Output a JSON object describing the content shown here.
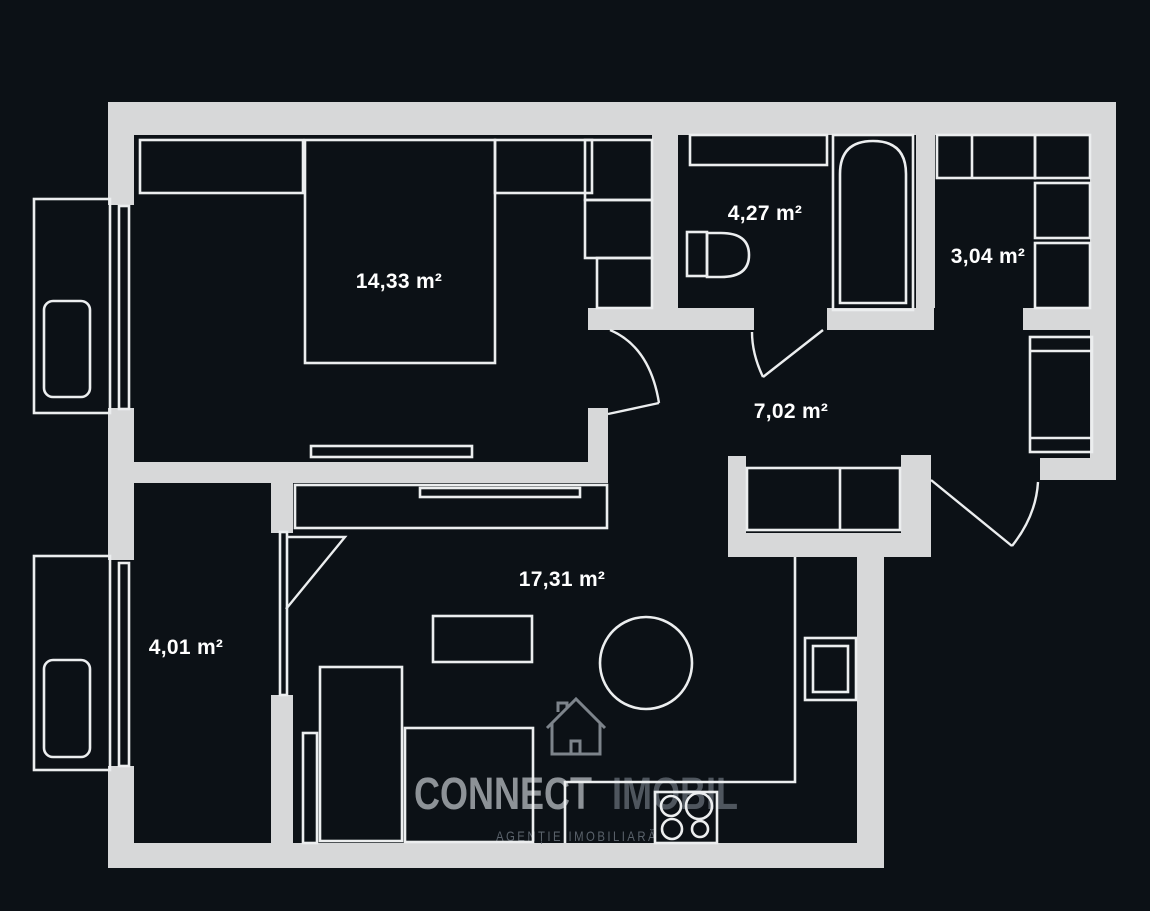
{
  "colors": {
    "background": "#0c1116",
    "wall": "#d7d8d9",
    "furniture_line": "#eceeef",
    "label_text": "#ffffff",
    "logo_primary": "#8d9297",
    "logo_secondary": "#4f565e",
    "tagline": "#5a626b",
    "watermark_icon": "#7d848b"
  },
  "branding": {
    "logo_primary": "CONNECT",
    "logo_secondary": "IMOBIL",
    "tagline": "AGENȚIE IMOBILIARĂ"
  },
  "rooms": [
    {
      "id": "bedroom",
      "area_label": "14,33 m²"
    },
    {
      "id": "bathroom",
      "area_label": "4,27 m²"
    },
    {
      "id": "dressing",
      "area_label": "3,04 m²"
    },
    {
      "id": "hallway",
      "area_label": "7,02 m²"
    },
    {
      "id": "small-room",
      "area_label": "4,01 m²"
    },
    {
      "id": "living-kitchen",
      "area_label": "17,31 m²"
    }
  ]
}
